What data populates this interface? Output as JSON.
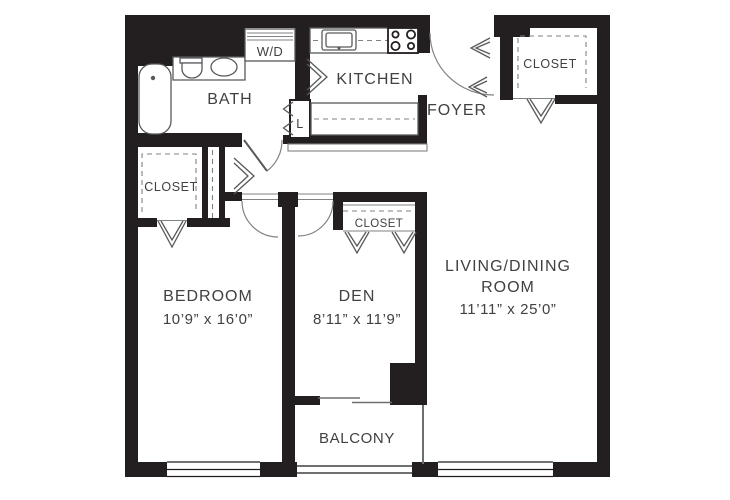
{
  "floorplan": {
    "colors": {
      "wall": "#231f20",
      "fixture_line": "#58595b",
      "light_line": "#808285",
      "text": "#414042",
      "background": "#ffffff"
    },
    "rooms": {
      "bath": {
        "label": "BATH"
      },
      "kitchen": {
        "label": "KITCHEN"
      },
      "foyer": {
        "label": "FOYER"
      },
      "closet_foyer": {
        "label": "CLOSET"
      },
      "closet_hall": {
        "label": "CLOSET"
      },
      "closet_den": {
        "label": "CLOSET"
      },
      "washer_dryer": {
        "label": "W/D"
      },
      "linen": {
        "label": "L"
      },
      "bedroom": {
        "label": "BEDROOM",
        "dimensions": "10’9” x 16’0”"
      },
      "den": {
        "label": "DEN",
        "dimensions": "8’11” x 11’9”"
      },
      "living_dining": {
        "label_line1": "LIVING/DINING",
        "label_line2": "ROOM",
        "dimensions": "11’11” x 25’0”"
      },
      "balcony": {
        "label": "BALCONY"
      }
    }
  }
}
